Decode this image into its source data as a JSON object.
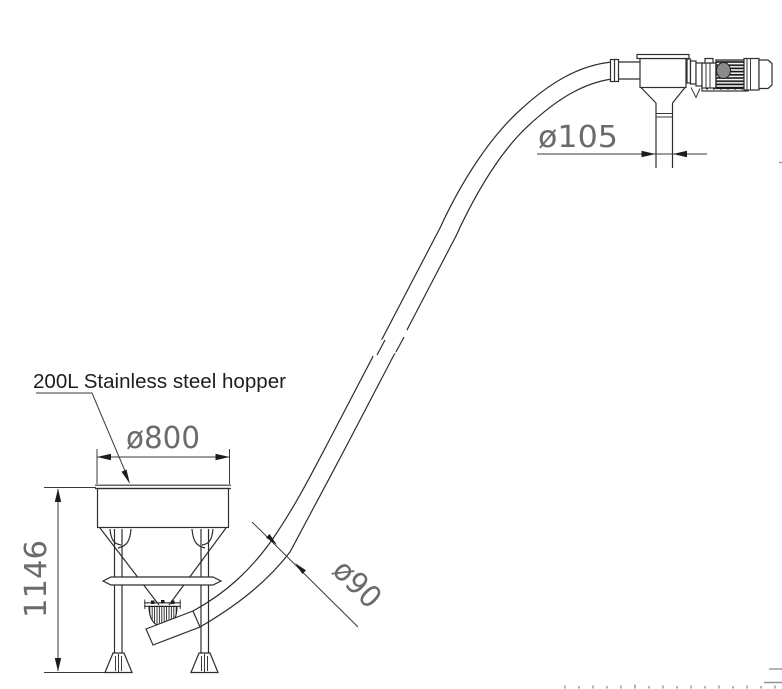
{
  "drawing": {
    "hopper_label": "200L Stainless steel hopper",
    "dimensions": {
      "hopper_diameter": "ø800",
      "hopper_height": "1146",
      "discharge_diameter": "ø105",
      "tube_diameter": "ø90"
    },
    "colors": {
      "line": "#2e2e2e",
      "dimension_text": "#6b6b6b",
      "label_text": "#1e1e1e",
      "faint_marks": "#949494",
      "background": "#ffffff"
    }
  }
}
